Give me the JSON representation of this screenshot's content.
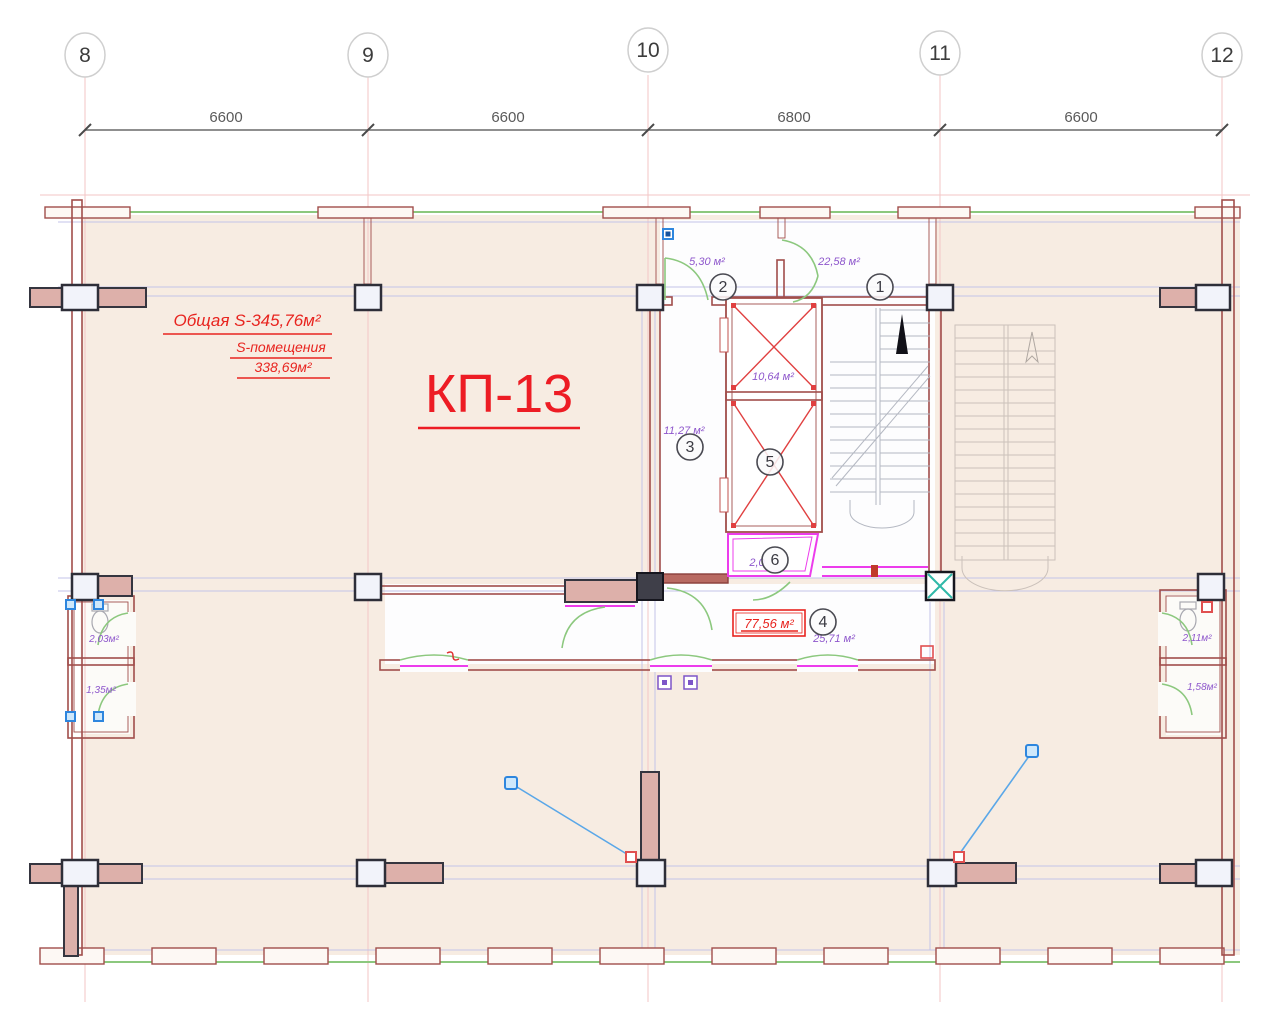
{
  "axes": {
    "bubbles": [
      "8",
      "9",
      "10",
      "11",
      "12"
    ],
    "dimensions": [
      "6600",
      "6600",
      "6800",
      "6600"
    ]
  },
  "areas": {
    "total": "Общая S-345,76м²",
    "premises_label": "S-помещения",
    "premises_value": "338,69м²",
    "unit_label": "КП-13",
    "boxed": "77,56 м²"
  },
  "rooms": [
    {
      "num": "1",
      "area": "22,58 м²"
    },
    {
      "num": "2",
      "area": "5,30 м²"
    },
    {
      "num": "3",
      "area": "11,27 м²"
    },
    {
      "num": "4",
      "area": "25,71 м²"
    },
    {
      "num": "5",
      "area": "10,64 м²"
    },
    {
      "num": "6",
      "area": "2,0"
    }
  ],
  "wc_rooms": [
    {
      "area": "2,03м²"
    },
    {
      "area": "1,35м²"
    },
    {
      "area": "2,11м²"
    },
    {
      "area": "1,58м²"
    }
  ],
  "colors": {
    "floor_beige": "#f7ece2",
    "wall_red": "#a14e4b",
    "wall_pink_fill": "#ddb0aa",
    "window_green": "#8cc87e",
    "magenta": "#ec3cec",
    "purple_text": "#8e57cc",
    "red_text": "#e8241f",
    "leader_blue": "#5aa7e8",
    "teal": "#2fb8a8"
  }
}
